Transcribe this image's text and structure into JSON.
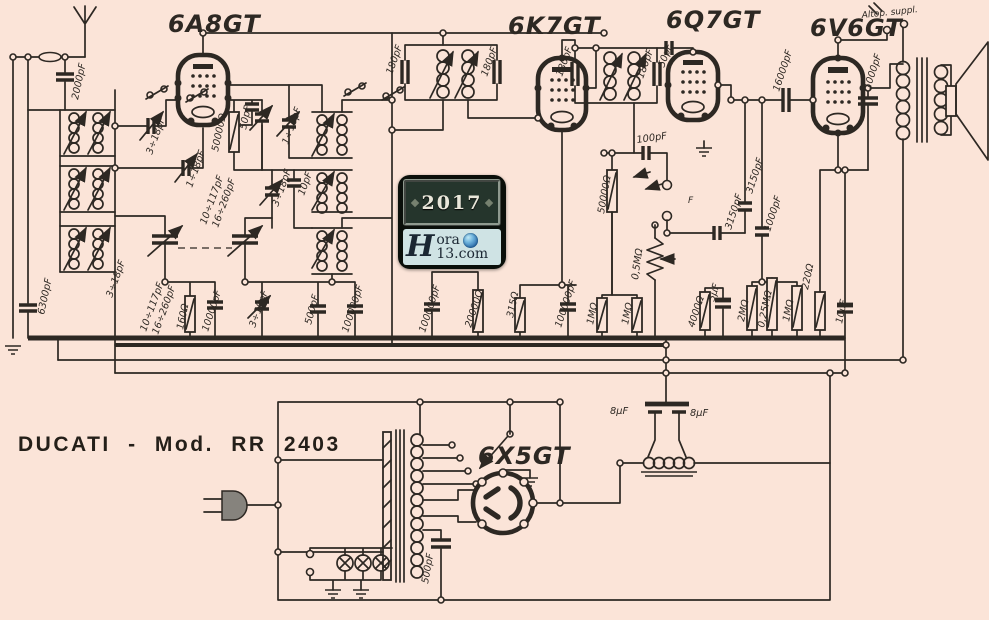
{
  "title": "DUCATI - Mod. RR 2403",
  "watermark": {
    "year": "2017",
    "initial": "H",
    "line1": "ora",
    "line2": "13.com"
  },
  "colors": {
    "paper": "#fbe4d8",
    "ink": "#2d2823",
    "wmplate": "#25352c",
    "wmband": "#cfe3e4",
    "globe": "#2a6aa8"
  },
  "schematic": {
    "labels": [
      {
        "t": "6A8GT",
        "x": 168,
        "y": 32,
        "r": 0,
        "c": "tube"
      },
      {
        "t": "6K7GT",
        "x": 508,
        "y": 34,
        "r": 0,
        "c": "tube"
      },
      {
        "t": "6Q7GT",
        "x": 666,
        "y": 28,
        "r": 0,
        "c": "tube"
      },
      {
        "t": "6V6GT",
        "x": 810,
        "y": 36,
        "r": 0,
        "c": "tube"
      },
      {
        "t": "6X5GT",
        "x": 478,
        "y": 464,
        "r": 0,
        "c": "tube"
      },
      {
        "t": "2000pF",
        "x": 78,
        "y": 100,
        "r": -78
      },
      {
        "t": "6300pF",
        "x": 44,
        "y": 315,
        "r": -78
      },
      {
        "t": "3÷18pF",
        "x": 152,
        "y": 155,
        "r": -70
      },
      {
        "t": "1÷18pF",
        "x": 192,
        "y": 188,
        "r": -70
      },
      {
        "t": "50000Ω",
        "x": 218,
        "y": 152,
        "r": -78
      },
      {
        "t": "50pF",
        "x": 246,
        "y": 130,
        "r": -78
      },
      {
        "t": "10÷117pF",
        "x": 206,
        "y": 225,
        "r": -70
      },
      {
        "t": "16÷260pF",
        "x": 218,
        "y": 228,
        "r": -70
      },
      {
        "t": "1÷18pF",
        "x": 288,
        "y": 145,
        "r": -70
      },
      {
        "t": "10pF",
        "x": 304,
        "y": 196,
        "r": -70
      },
      {
        "t": "3÷18pF",
        "x": 278,
        "y": 207,
        "r": -70
      },
      {
        "t": "3÷18pF",
        "x": 112,
        "y": 298,
        "r": -70
      },
      {
        "t": "10÷117pF",
        "x": 146,
        "y": 332,
        "r": -70
      },
      {
        "t": "16÷260pF",
        "x": 158,
        "y": 335,
        "r": -70
      },
      {
        "t": "160Ω",
        "x": 183,
        "y": 330,
        "r": -78
      },
      {
        "t": "10000pF",
        "x": 208,
        "y": 332,
        "r": -72
      },
      {
        "t": "3÷18pF",
        "x": 255,
        "y": 328,
        "r": -70
      },
      {
        "t": "500pF",
        "x": 311,
        "y": 325,
        "r": -75
      },
      {
        "t": "100000pF",
        "x": 348,
        "y": 333,
        "r": -72
      },
      {
        "t": "180pF",
        "x": 392,
        "y": 75,
        "r": -70
      },
      {
        "t": "180pF",
        "x": 487,
        "y": 77,
        "r": -70
      },
      {
        "t": "100000pF",
        "x": 425,
        "y": 333,
        "r": -72
      },
      {
        "t": "20000Ω",
        "x": 471,
        "y": 328,
        "r": -72
      },
      {
        "t": "315Ω",
        "x": 513,
        "y": 318,
        "r": -78
      },
      {
        "t": "100000pF",
        "x": 561,
        "y": 328,
        "r": -72
      },
      {
        "t": "180pF",
        "x": 562,
        "y": 77,
        "r": -70
      },
      {
        "t": "180pF",
        "x": 643,
        "y": 79,
        "r": -70
      },
      {
        "t": "50pF",
        "x": 664,
        "y": 68,
        "r": -70
      },
      {
        "t": "100pF",
        "x": 637,
        "y": 143,
        "r": -8
      },
      {
        "t": "50000Ω",
        "x": 604,
        "y": 214,
        "r": -80
      },
      {
        "t": "F",
        "x": 688,
        "y": 203,
        "r": 0,
        "c": "tiny"
      },
      {
        "t": "0,5MΩ",
        "x": 638,
        "y": 280,
        "r": -82
      },
      {
        "t": "3150pF",
        "x": 731,
        "y": 230,
        "r": -72
      },
      {
        "t": "3150pF",
        "x": 752,
        "y": 194,
        "r": -72
      },
      {
        "t": "1000pF",
        "x": 770,
        "y": 232,
        "r": -72
      },
      {
        "t": "1MΩ",
        "x": 593,
        "y": 325,
        "r": -78
      },
      {
        "t": "1MΩ",
        "x": 628,
        "y": 325,
        "r": -78
      },
      {
        "t": "4000Ω",
        "x": 694,
        "y": 328,
        "r": -72
      },
      {
        "t": "5µF",
        "x": 714,
        "y": 302,
        "r": -72
      },
      {
        "t": "2MΩ",
        "x": 744,
        "y": 322,
        "r": -78
      },
      {
        "t": "0,25MΩ",
        "x": 764,
        "y": 328,
        "r": -78
      },
      {
        "t": "1MΩ",
        "x": 789,
        "y": 322,
        "r": -78
      },
      {
        "t": "220Ω",
        "x": 808,
        "y": 290,
        "r": -78
      },
      {
        "t": "10µF",
        "x": 842,
        "y": 324,
        "r": -78
      },
      {
        "t": "16000pF",
        "x": 779,
        "y": 92,
        "r": -72
      },
      {
        "t": "1000pF",
        "x": 870,
        "y": 90,
        "r": -72
      },
      {
        "t": "Altop. suppl.",
        "x": 862,
        "y": 18,
        "r": -6,
        "c": "tiny"
      },
      {
        "t": "8µF",
        "x": 610,
        "y": 414,
        "r": 0
      },
      {
        "t": "8µF",
        "x": 690,
        "y": 416,
        "r": 0
      },
      {
        "t": "500pF",
        "x": 428,
        "y": 584,
        "r": -80
      }
    ]
  }
}
